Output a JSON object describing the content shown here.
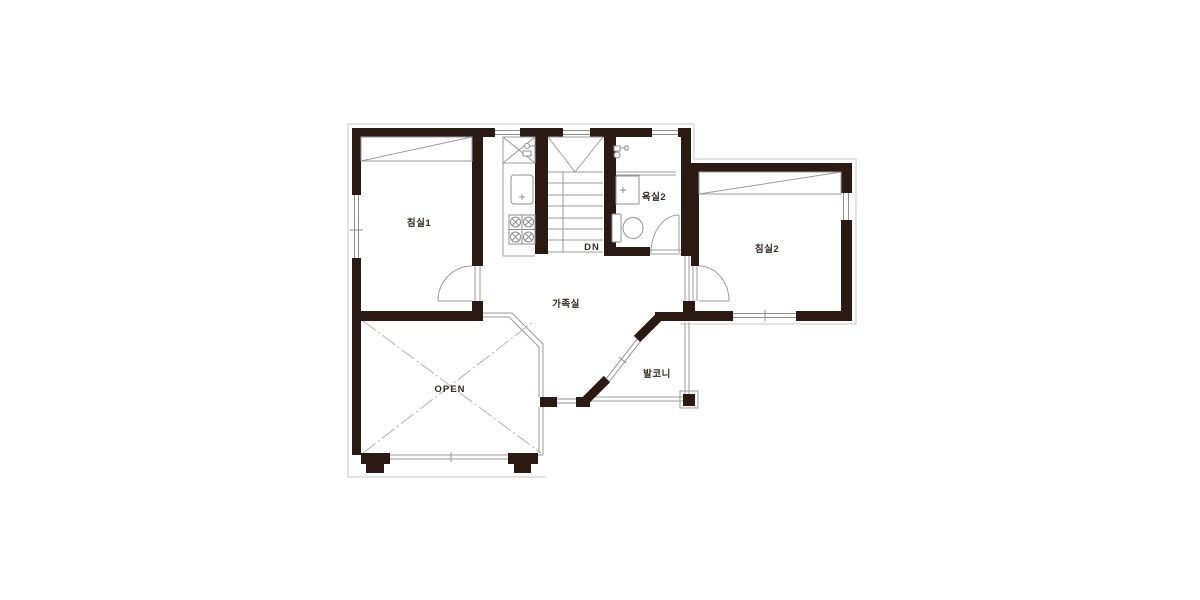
{
  "plan": {
    "rooms": {
      "bedroom1": {
        "label": "침실1"
      },
      "bedroom2": {
        "label": "침실2"
      },
      "bathroom2": {
        "label": "욕실2"
      },
      "family_room": {
        "label": "가족실"
      },
      "balcony": {
        "label": "발코니"
      },
      "open_void": {
        "label": "OPEN"
      }
    },
    "stairs": {
      "direction_label": "DN"
    },
    "colors": {
      "wall": "#2a1a11",
      "line": "#9b9b9b",
      "light_line": "#cbc7c4",
      "text": "#342a25",
      "background": "#ffffff"
    }
  }
}
